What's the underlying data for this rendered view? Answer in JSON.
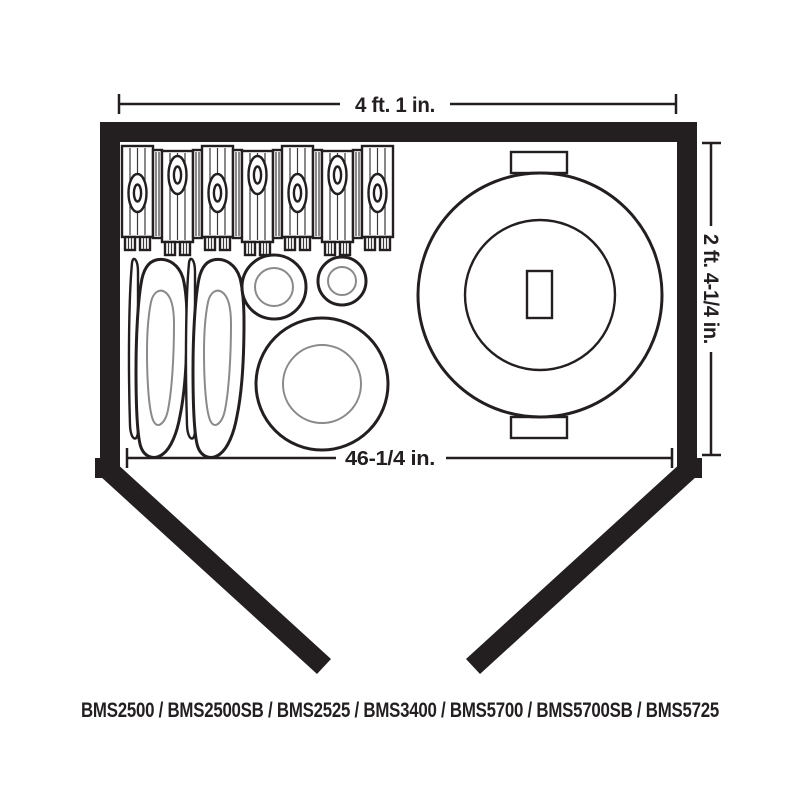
{
  "diagram": {
    "title": "BMS2500 / BMS2500SB / BMS2525 / BMS3400 / BMS5700 / BMS5700SB / BMS5725",
    "dimensions": {
      "width": "4 ft. 1 in.",
      "depth": "2 ft. 4-1/4 in.",
      "opening": "46-1/4 in."
    },
    "icons": {
      "firewood": "stacked-firewood-icon",
      "bags": "storage-bags-icon",
      "planters": "round-planters-icon",
      "trash_can": "trash-can-icon"
    },
    "colors": {
      "wall": "#231f20",
      "outline": "#231f20",
      "inner_outline": "#8a8a8a",
      "background": "#ffffff"
    }
  }
}
